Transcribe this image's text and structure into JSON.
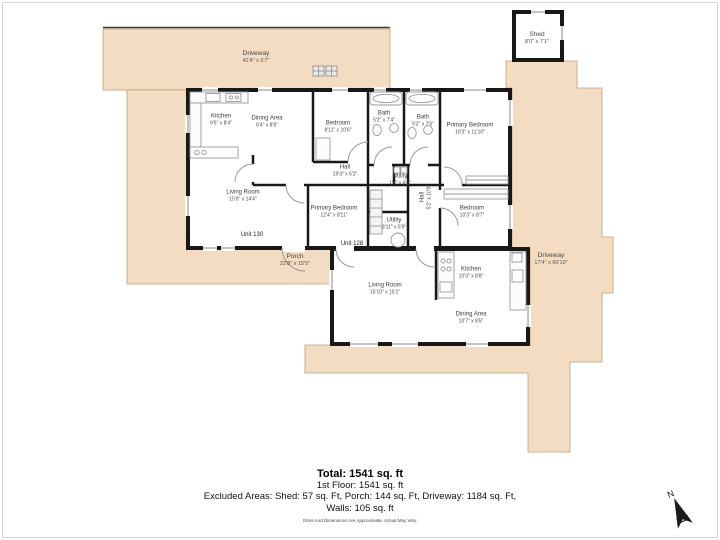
{
  "areas": {
    "driveway_top": {
      "name": "Driveway",
      "dims": "41'4\" x 9'7\""
    },
    "shed": {
      "name": "Shed",
      "dims": "8'0\" x 7'1\""
    },
    "porch": {
      "name": "Porch",
      "dims": "22'8\" x 15'5\""
    },
    "driveway_right": {
      "name": "Driveway",
      "dims": "17'4\" x 60'10\""
    }
  },
  "units": {
    "unit130": "Unit 130",
    "unit128": "Unit 128"
  },
  "rooms": {
    "kitchen1": {
      "name": "Kitchen",
      "dims": "9'5\" x 8'4\""
    },
    "dining1": {
      "name": "Dining Area",
      "dims": "6'4\" x 8'8\""
    },
    "bedroom1": {
      "name": "Bedroom",
      "dims": "8'11\" x 10'6\""
    },
    "bath1": {
      "name": "Bath",
      "dims": "5'2\" x 7'4\""
    },
    "bath2": {
      "name": "Bath",
      "dims": "5'2\" x 7'6\""
    },
    "primary1": {
      "name": "Primary Bedroom",
      "dims": "10'3\" x 11'10\""
    },
    "hall1": {
      "name": "Hall",
      "dims": "19'3\" x 6'2\""
    },
    "living1": {
      "name": "Living Room",
      "dims": "15'9\" x 14'4\""
    },
    "primary2": {
      "name": "Primary Bedroom",
      "dims": "12'4\" x 8'11\""
    },
    "utility1": {
      "name": "Utility",
      "dims": "1'4\" x 6'2\""
    },
    "utility2": {
      "name": "Utility",
      "dims": "3'11\" x 5'9\""
    },
    "hall2": {
      "name": "Hall",
      "dims": "5'2\" x 10'9\""
    },
    "bedroom2": {
      "name": "Bedroom",
      "dims": "10'3\" x 8'7\""
    },
    "living2": {
      "name": "Living Room",
      "dims": "15'10\" x 15'1\""
    },
    "kitchen2": {
      "name": "Kitchen",
      "dims": "10'3\" x 8'8\""
    },
    "dining2": {
      "name": "Dining Area",
      "dims": "10'7\" x 8'5\""
    }
  },
  "summary": {
    "total": "Total: 1541 sq. ft",
    "first_floor": "1st Floor: 1541 sq. ft",
    "excluded": "Excluded Areas: Shed: 57 sq. Ft, Porch: 144 sq. Ft, Driveway: 1184 sq. Ft,",
    "walls": "Walls: 105 sq. ft",
    "disclaimer": "Sizes And Dimensions Are Approximate, Actual May Vary."
  },
  "compass": {
    "label": "N"
  },
  "colors": {
    "paved": "#f3dcc1",
    "paved_edge": "#c59e71",
    "wall": "#181818",
    "fixture": "#9a9a9a"
  }
}
